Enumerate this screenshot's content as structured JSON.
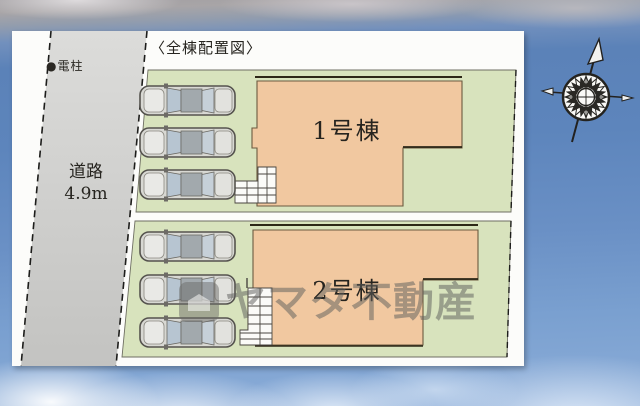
{
  "plan": {
    "title": "〈全棟配置図〉",
    "pole_label": "●電柱",
    "road_label": [
      "道路",
      "4.9m"
    ],
    "buildings": [
      {
        "label": "1号棟"
      },
      {
        "label": "2号棟"
      }
    ],
    "parking": {
      "cars_lot1": 3,
      "cars_lot2": 3
    }
  },
  "watermark": {
    "text": "ヤマタ不動産"
  },
  "compass": {
    "direction": "north-tilted-right"
  },
  "colors": {
    "lot_green": "#d8e3bd",
    "building_peach": "#f1c8a0",
    "road_gray": "#cfcfcd",
    "panel_white": "#fcfcfa",
    "sky_blue": "#5d85bc",
    "watermark_gray": "#60605e"
  }
}
